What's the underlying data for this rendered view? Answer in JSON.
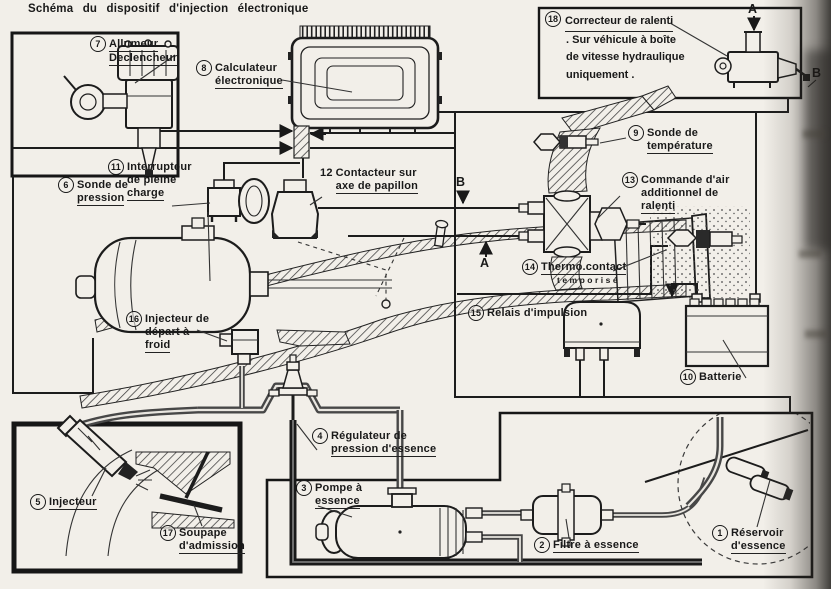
{
  "page": {
    "title": "Schéma du dispositif d'injection électronique"
  },
  "inset": {
    "number": "18",
    "lines": [
      "Correcteur de ralenti",
      ". Sur véhicule à boîte",
      "de vitesse hydraulique",
      "uniquement ."
    ]
  },
  "components": {
    "c1": {
      "number": "1",
      "lines": [
        "Réservoir",
        "d'essence"
      ]
    },
    "c2": {
      "number": "2",
      "lines": [
        "Filtre à essence"
      ]
    },
    "c3": {
      "number": "3",
      "lines": [
        "Pompe à",
        "essence"
      ]
    },
    "c4": {
      "number": "4",
      "lines": [
        "Régulateur de",
        "pression d'essence"
      ]
    },
    "c5": {
      "number": "5",
      "lines": [
        "Injecteur"
      ]
    },
    "c6": {
      "number": "6",
      "lines": [
        "Sonde de",
        "pression"
      ]
    },
    "c7": {
      "number": "7",
      "lines": [
        "Allumeur",
        "Declencheur"
      ]
    },
    "c8": {
      "number": "8",
      "lines": [
        "Calculateur",
        "électronique"
      ]
    },
    "c9": {
      "number": "9",
      "lines": [
        "Sonde de",
        "température"
      ]
    },
    "c10": {
      "number": "10",
      "lines": [
        "Batterie"
      ]
    },
    "c11": {
      "number": "11",
      "lines": [
        "Interrupteur",
        "de pleine",
        "charge"
      ]
    },
    "c12": {
      "number": "12",
      "lines": [
        "Contacteur sur",
        "axe de papillon"
      ]
    },
    "c13": {
      "number": "13",
      "lines": [
        "Commande d'air",
        "additionnel de",
        "ralenti"
      ]
    },
    "c14": {
      "number": "14",
      "lines": [
        "Thermo.contact",
        "temporisé"
      ]
    },
    "c15": {
      "number": "15",
      "lines": [
        "Relais d'impulsion"
      ]
    },
    "c16": {
      "number": "16",
      "lines": [
        "Injecteur de",
        "départ à",
        "froid"
      ]
    },
    "c17": {
      "number": "17",
      "lines": [
        "Soupape",
        "d'admission"
      ]
    }
  },
  "letters": {
    "a_main": "A",
    "b_main": "B",
    "a_inset": "A",
    "b_inset": "B"
  },
  "colors": {
    "ink": "#1c1c1c",
    "paper": "#f2efe9",
    "pipe": "#474747"
  }
}
